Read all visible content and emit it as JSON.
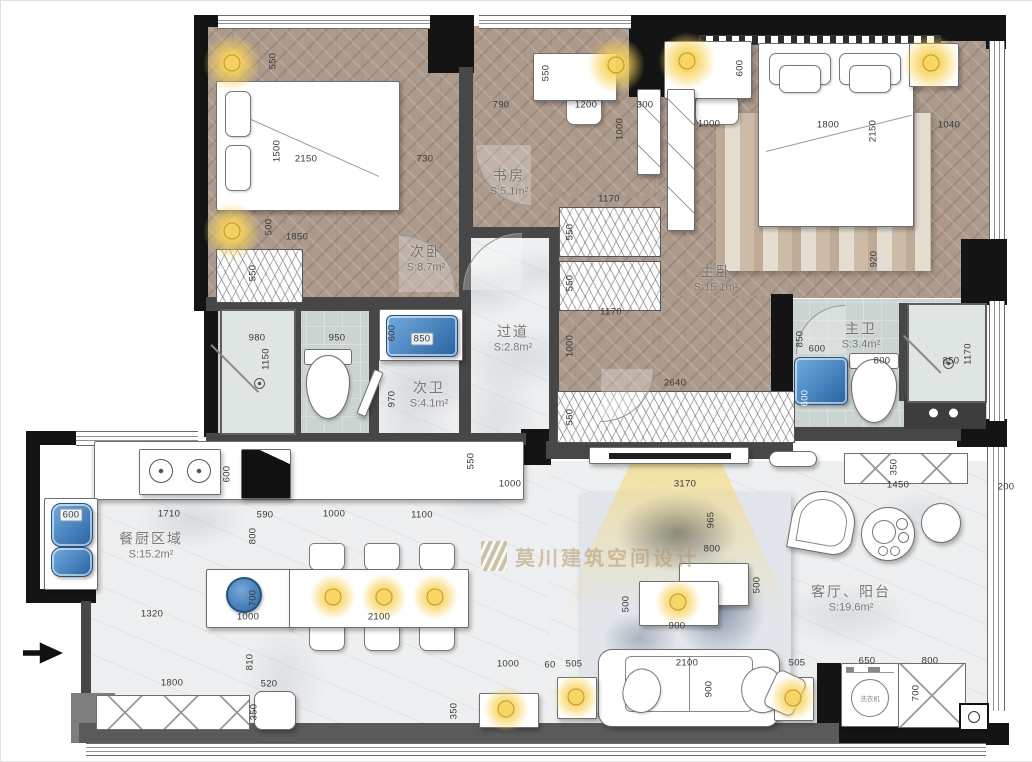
{
  "watermark": {
    "brand": "莫川建筑空间设计"
  },
  "fixtures": {
    "washer": "洗衣机"
  },
  "colors": {
    "light_glow": "#f2cf63",
    "sink_blue": "#3f7fba",
    "watermark_gold": "#b49a6a",
    "wall_black": "#141414",
    "wall_gray": "#474747",
    "wood_floor": "#ac9a8c"
  },
  "rooms": {
    "bedroom2": {
      "label": "次卧",
      "area": "S:8.7m²"
    },
    "study": {
      "label": "书房",
      "area": "S:5.1m²"
    },
    "master": {
      "label": "主卧",
      "area": "S:15.1m²"
    },
    "master_bath": {
      "label": "主卫",
      "area": "S:3.4m²"
    },
    "bath2": {
      "label": "次卫",
      "area": "S:4.1m²"
    },
    "corridor": {
      "label": "过道",
      "area": "S:2.8m²"
    },
    "dining_kitchen": {
      "label": "餐厨区域",
      "area": "S:15.2m²"
    },
    "living": {
      "label": "客厅、阳台",
      "area": "S:19.6m²"
    }
  },
  "dimensions": [
    {
      "x": 272,
      "y": 60,
      "t": "550",
      "v": 1
    },
    {
      "x": 276,
      "y": 150,
      "t": "1500",
      "v": 1
    },
    {
      "x": 305,
      "y": 158,
      "t": "2150"
    },
    {
      "x": 424,
      "y": 158,
      "t": "730"
    },
    {
      "x": 268,
      "y": 226,
      "t": "500",
      "v": 1
    },
    {
      "x": 296,
      "y": 236,
      "t": "1850"
    },
    {
      "x": 252,
      "y": 272,
      "t": "550",
      "v": 1
    },
    {
      "x": 500,
      "y": 104,
      "t": "790"
    },
    {
      "x": 545,
      "y": 72,
      "t": "550",
      "v": 1
    },
    {
      "x": 585,
      "y": 104,
      "t": "1200"
    },
    {
      "x": 644,
      "y": 104,
      "t": "300"
    },
    {
      "x": 619,
      "y": 128,
      "t": "1000",
      "v": 1
    },
    {
      "x": 608,
      "y": 198,
      "t": "1170"
    },
    {
      "x": 739,
      "y": 67,
      "t": "600",
      "v": 1
    },
    {
      "x": 708,
      "y": 123,
      "t": "1000"
    },
    {
      "x": 827,
      "y": 124,
      "t": "1800"
    },
    {
      "x": 872,
      "y": 130,
      "t": "2150",
      "v": 1
    },
    {
      "x": 948,
      "y": 124,
      "t": "1040"
    },
    {
      "x": 873,
      "y": 258,
      "t": "920",
      "v": 1
    },
    {
      "x": 569,
      "y": 231,
      "t": "550",
      "v": 1
    },
    {
      "x": 569,
      "y": 282,
      "t": "550",
      "v": 1
    },
    {
      "x": 610,
      "y": 311,
      "t": "1170"
    },
    {
      "x": 569,
      "y": 345,
      "t": "1000",
      "v": 1
    },
    {
      "x": 674,
      "y": 382,
      "t": "2640"
    },
    {
      "x": 569,
      "y": 416,
      "t": "550",
      "v": 1
    },
    {
      "x": 799,
      "y": 338,
      "t": "850",
      "v": 1
    },
    {
      "x": 816,
      "y": 348,
      "t": "600"
    },
    {
      "x": 881,
      "y": 360,
      "t": "800"
    },
    {
      "x": 950,
      "y": 360,
      "t": "850"
    },
    {
      "x": 967,
      "y": 353,
      "t": "1170",
      "v": 1
    },
    {
      "x": 804,
      "y": 397,
      "t": "600",
      "v": 1,
      "light": 1
    },
    {
      "x": 256,
      "y": 337,
      "t": "980"
    },
    {
      "x": 265,
      "y": 358,
      "t": "1150",
      "v": 1
    },
    {
      "x": 336,
      "y": 337,
      "t": "950"
    },
    {
      "x": 391,
      "y": 332,
      "t": "600",
      "v": 1
    },
    {
      "x": 421,
      "y": 338,
      "t": "850",
      "chip": 1
    },
    {
      "x": 391,
      "y": 398,
      "t": "970",
      "v": 1
    },
    {
      "x": 470,
      "y": 460,
      "t": "550",
      "v": 1
    },
    {
      "x": 509,
      "y": 483,
      "t": "1000"
    },
    {
      "x": 70,
      "y": 514,
      "t": "600",
      "chip": 1
    },
    {
      "x": 226,
      "y": 473,
      "t": "600",
      "v": 1
    },
    {
      "x": 168,
      "y": 513,
      "t": "1710"
    },
    {
      "x": 264,
      "y": 514,
      "t": "590"
    },
    {
      "x": 333,
      "y": 513,
      "t": "1000"
    },
    {
      "x": 421,
      "y": 514,
      "t": "1100"
    },
    {
      "x": 252,
      "y": 535,
      "t": "800",
      "v": 1
    },
    {
      "x": 151,
      "y": 613,
      "t": "1320"
    },
    {
      "x": 247,
      "y": 616,
      "t": "1000"
    },
    {
      "x": 252,
      "y": 597,
      "t": "700",
      "v": 1
    },
    {
      "x": 378,
      "y": 616,
      "t": "2100"
    },
    {
      "x": 249,
      "y": 661,
      "t": "810",
      "v": 1
    },
    {
      "x": 268,
      "y": 683,
      "t": "520"
    },
    {
      "x": 253,
      "y": 711,
      "t": "350",
      "v": 1
    },
    {
      "x": 171,
      "y": 682,
      "t": "1800"
    },
    {
      "x": 453,
      "y": 710,
      "t": "350",
      "v": 1
    },
    {
      "x": 684,
      "y": 483,
      "t": "3170"
    },
    {
      "x": 710,
      "y": 519,
      "t": "965",
      "v": 1
    },
    {
      "x": 711,
      "y": 548,
      "t": "800"
    },
    {
      "x": 756,
      "y": 584,
      "t": "500",
      "v": 1
    },
    {
      "x": 625,
      "y": 603,
      "t": "500",
      "v": 1
    },
    {
      "x": 676,
      "y": 625,
      "t": "900"
    },
    {
      "x": 897,
      "y": 484,
      "t": "1450"
    },
    {
      "x": 1005,
      "y": 486,
      "t": "200"
    },
    {
      "x": 893,
      "y": 466,
      "t": "350",
      "v": 1
    },
    {
      "x": 507,
      "y": 663,
      "t": "1000"
    },
    {
      "x": 549,
      "y": 664,
      "t": "60"
    },
    {
      "x": 573,
      "y": 663,
      "t": "505"
    },
    {
      "x": 686,
      "y": 662,
      "t": "2100"
    },
    {
      "x": 708,
      "y": 688,
      "t": "900",
      "v": 1
    },
    {
      "x": 796,
      "y": 662,
      "t": "505"
    },
    {
      "x": 866,
      "y": 660,
      "t": "650"
    },
    {
      "x": 929,
      "y": 660,
      "t": "800"
    },
    {
      "x": 915,
      "y": 692,
      "t": "700",
      "v": 1
    }
  ]
}
